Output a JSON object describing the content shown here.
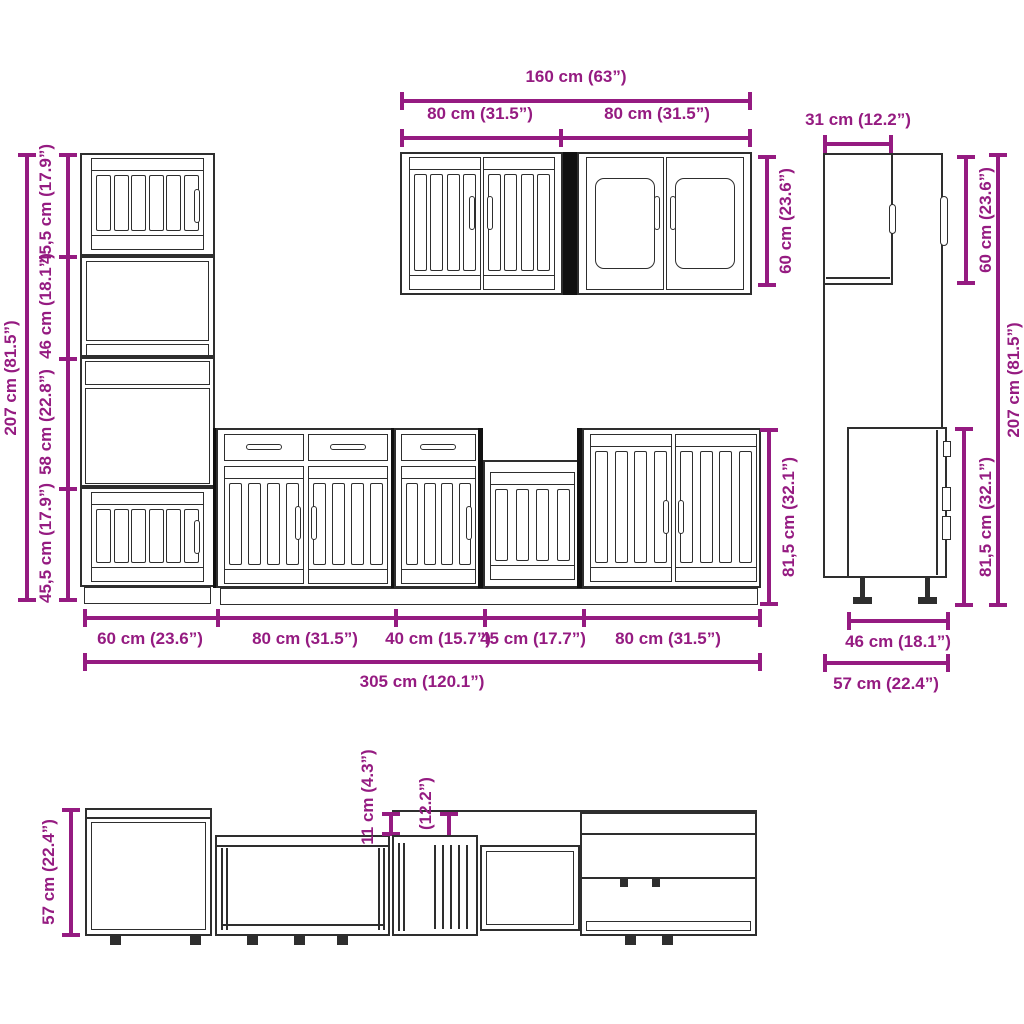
{
  "diagram_title": "kitchen-cabinet-set-dimension-diagram",
  "colors": {
    "dimension": "#951b81",
    "line": "#2e2e2e",
    "background": "#ffffff"
  },
  "front": {
    "total_height": "207 cm (81.5”)",
    "tall_sections": [
      "45,5 cm (17.9”)",
      "46 cm (18.1”)",
      "58 cm (22.8”)",
      "45,5 cm (17.9”)"
    ],
    "wall_total_width": "160 cm (63”)",
    "wall_widths": [
      "80 cm (31.5”)",
      "80 cm (31.5”)"
    ],
    "wall_height": "60 cm (23.6”)",
    "base_height": "81,5 cm (32.1”)",
    "base_widths": [
      "60 cm (23.6”)",
      "80 cm (31.5”)",
      "40 cm (15.7”)",
      "45 cm (17.7”)",
      "80 cm (31.5”)"
    ],
    "total_width": "305 cm (120.1”)"
  },
  "side": {
    "wall_depth": "31 cm (12.2”)",
    "wall_height": "60 cm (23.6”)",
    "total_height": "207 cm (81.5”)",
    "base_height": "81,5 cm (32.1”)",
    "base_depth": "46 cm (18.1”)",
    "total_depth": "57 cm (22.4”)"
  },
  "top": {
    "depth": "57 cm (22.4”)",
    "front_offset": "11 cm (4.3”)",
    "wall_depth": "31 cm (12.2”)"
  }
}
